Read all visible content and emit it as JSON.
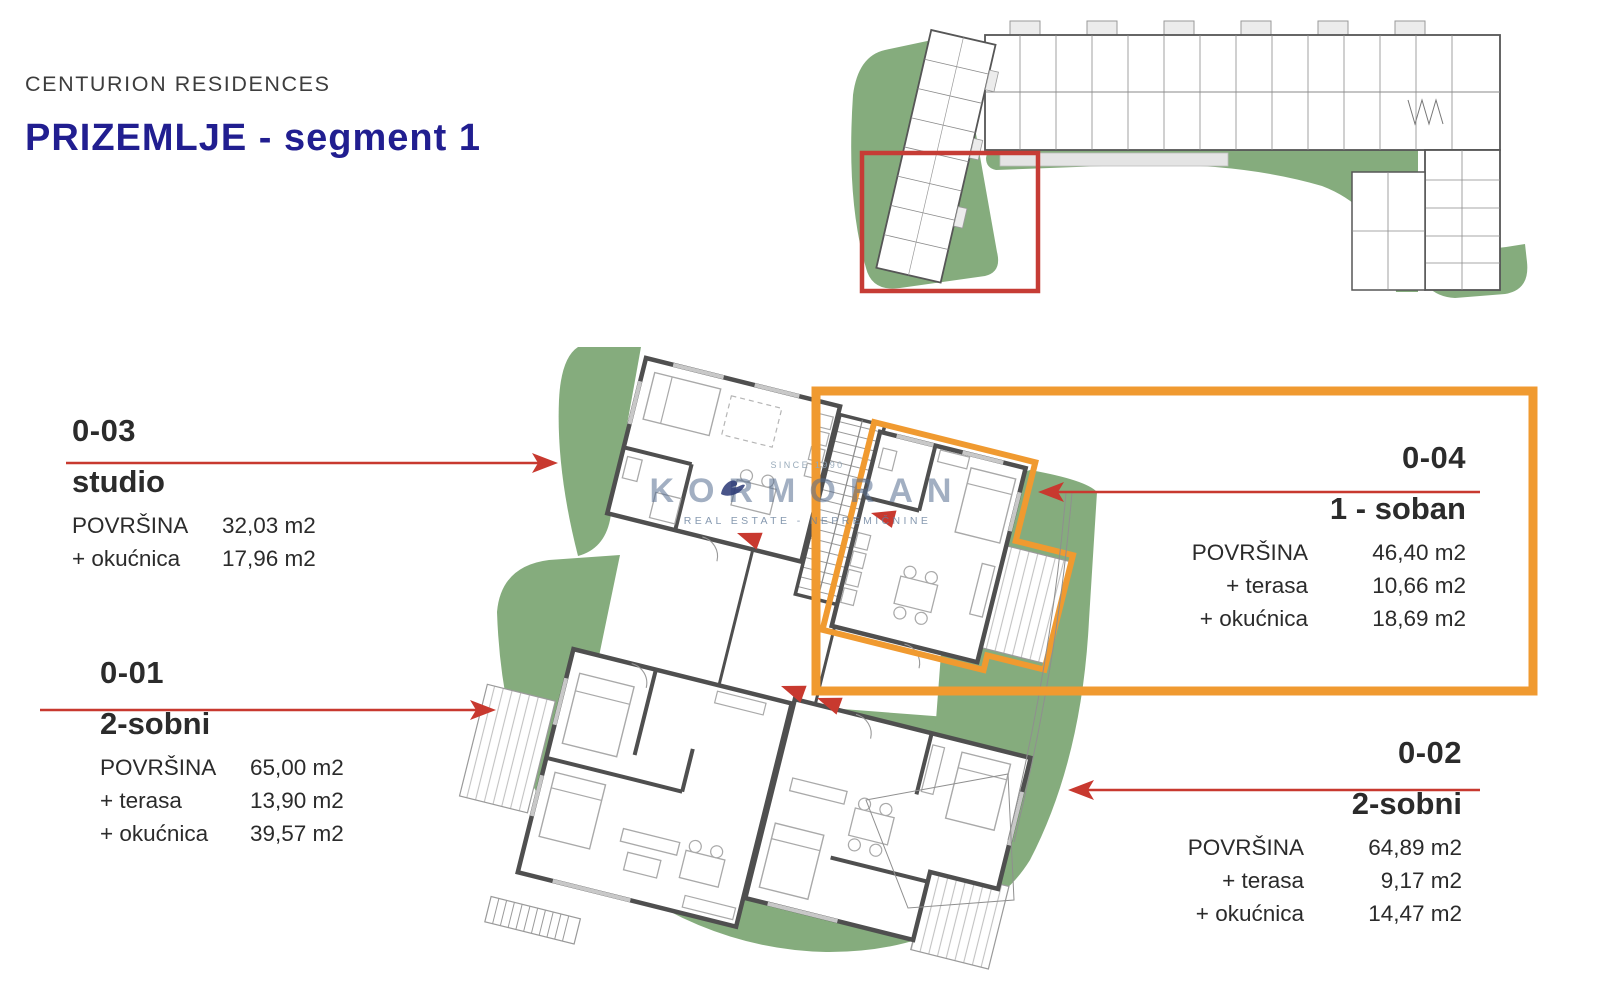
{
  "header": {
    "project": "CENTURION RESIDENCES",
    "title": "PRIZEMLJE - segment 1"
  },
  "watermark": {
    "since": "SINCE 1990",
    "brand": "KORMORAN",
    "tagline": "REAL ESTATE - NEPREMIČNINE"
  },
  "units": {
    "u03": {
      "id": "0-03",
      "type": "studio",
      "rows": [
        {
          "label": "POVRŠINA",
          "value": "32,03 m2"
        },
        {
          "label": "+ okućnica",
          "value": "17,96 m2"
        }
      ]
    },
    "u01": {
      "id": "0-01",
      "type": "2-sobni",
      "rows": [
        {
          "label": "POVRŠINA",
          "value": "65,00 m2"
        },
        {
          "label": "+ terasa",
          "value": "13,90 m2"
        },
        {
          "label": "+ okućnica",
          "value": "39,57 m2"
        }
      ]
    },
    "u04": {
      "id": "0-04",
      "type": "1 - soban",
      "rows": [
        {
          "label": "POVRŠINA",
          "value": "46,40 m2"
        },
        {
          "label": "+ terasa",
          "value": "10,66 m2"
        },
        {
          "label": "+ okućnica",
          "value": "18,69 m2"
        }
      ]
    },
    "u02": {
      "id": "0-02",
      "type": "2-sobni",
      "rows": [
        {
          "label": "POVRŠINA",
          "value": "64,89 m2"
        },
        {
          "label": "+ terasa",
          "value": "9,17 m2"
        },
        {
          "label": "+ okućnica",
          "value": "14,47 m2"
        }
      ]
    }
  },
  "highlight": {
    "selected_unit": "0-04"
  },
  "colors": {
    "title_navy": "#211e90",
    "accent_red": "#c8392f",
    "accent_orange": "#f09a30",
    "landscape_green": "#85ac7d",
    "wall_gray": "#4f4f4f",
    "text": "#2b2b2b"
  }
}
